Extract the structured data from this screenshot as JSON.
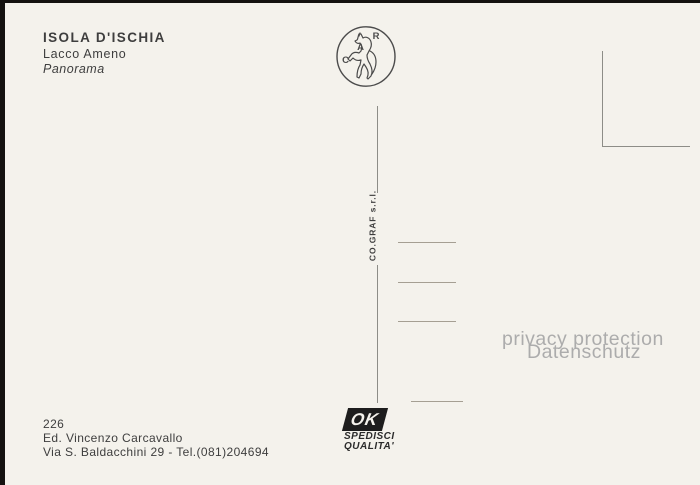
{
  "postcard": {
    "title": "ISOLA D'ISCHIA",
    "location": "Lacco Ameno",
    "caption": "Panorama",
    "number": "226",
    "publisher": "Ed. Vincenzo Carcavallo",
    "publisher_address": "Via S. Baldacchini 29 - Tel.(081)204694",
    "printer": "CO.GRAF s.r.l.",
    "stamp_logo_letters": {
      "top": "R",
      "middle": "A",
      "bottom": "C"
    },
    "quality_mark": {
      "ok": "OK",
      "line1": "SPEDISCI",
      "line2": "QUALITA'"
    },
    "watermark": {
      "line1": "privacy protection",
      "line2": "Datenschutz"
    }
  },
  "colors": {
    "scan_background": "#141210",
    "card_background": "#f4f2ec",
    "ink": "#3e3e3e",
    "rule_line": "#8d8d87",
    "address_line": "#a59f93",
    "watermark": "#acacac",
    "mark_black": "#1d1d1d"
  }
}
